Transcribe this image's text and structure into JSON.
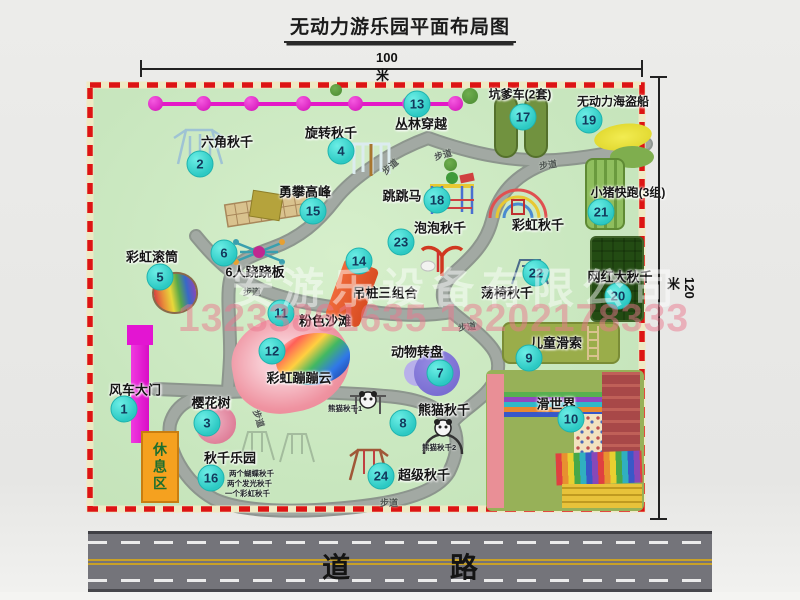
{
  "title": "无动力游乐园平面布局图",
  "dimensions": {
    "width_label": "100米",
    "height_label": "120米"
  },
  "road": {
    "label": "道  路"
  },
  "watermark": {
    "company": "安游乐设备有限公司",
    "phone": "13233861635 13202178333"
  },
  "walkway_label": "步道",
  "rest_area_label": "休息区",
  "park": {
    "attractions": [
      {
        "num": 1,
        "label": "风车大门",
        "bx": 124,
        "by": 409,
        "lx": 135,
        "ly": 389
      },
      {
        "num": 2,
        "label": "六角秋千",
        "bx": 200,
        "by": 164,
        "lx": 227,
        "ly": 141
      },
      {
        "num": 3,
        "label": "樱花树",
        "bx": 207,
        "by": 423,
        "lx": 211,
        "ly": 402
      },
      {
        "num": 4,
        "label": "旋转秋千",
        "bx": 341,
        "by": 151,
        "lx": 331,
        "ly": 132
      },
      {
        "num": 5,
        "label": "彩虹滚筒",
        "bx": 160,
        "by": 277,
        "lx": 152,
        "ly": 256
      },
      {
        "num": 6,
        "label": "6人跷跷板",
        "bx": 224,
        "by": 253,
        "lx": 255,
        "ly": 271
      },
      {
        "num": 7,
        "label": "动物转盘",
        "bx": 440,
        "by": 373,
        "lx": 417,
        "ly": 351
      },
      {
        "num": 8,
        "label": "熊猫秋千",
        "bx": 403,
        "by": 423,
        "lx": 444,
        "ly": 409
      },
      {
        "num": 9,
        "label": "儿童滑索",
        "bx": 529,
        "by": 358,
        "lx": 556,
        "ly": 342
      },
      {
        "num": 10,
        "label": "滑世界",
        "bx": 571,
        "by": 419,
        "lx": 556,
        "ly": 403
      },
      {
        "num": 11,
        "label": "粉色沙滩",
        "bx": 281,
        "by": 313,
        "lx": 325,
        "ly": 320
      },
      {
        "num": 12,
        "label": "彩虹蹦蹦云",
        "bx": 272,
        "by": 351,
        "lx": 299,
        "ly": 377
      },
      {
        "num": 13,
        "label": "丛林穿越",
        "bx": 417,
        "by": 104,
        "lx": 421,
        "ly": 123
      },
      {
        "num": 14,
        "label": "吊桩三组合",
        "bx": 359,
        "by": 261,
        "lx": 385,
        "ly": 292
      },
      {
        "num": 15,
        "label": "勇攀高峰",
        "bx": 313,
        "by": 211,
        "lx": 305,
        "ly": 191
      },
      {
        "num": 16,
        "label": "秋千乐园",
        "bx": 211,
        "by": 478,
        "lx": 230,
        "ly": 457
      },
      {
        "num": 17,
        "label": "坑爹车(2套)",
        "bx": 523,
        "by": 117,
        "lx": 520,
        "ly": 94,
        "fs": 12
      },
      {
        "num": 18,
        "label": "跳跳马",
        "bx": 437,
        "by": 200,
        "lx": 402,
        "ly": 195
      },
      {
        "num": 19,
        "label": "无动力海盗船",
        "bx": 589,
        "by": 120,
        "lx": 613,
        "ly": 101,
        "fs": 12
      },
      {
        "num": 20,
        "label": "网红大秋千",
        "bx": 618,
        "by": 296,
        "lx": 620,
        "ly": 276
      },
      {
        "num": 21,
        "label": "小猪快跑(3组)",
        "bx": 601,
        "by": 212,
        "lx": 628,
        "ly": 192,
        "fs": 12
      },
      {
        "num": 22,
        "label": "荡椅秋千",
        "bx": 536,
        "by": 273,
        "lx": 507,
        "ly": 292
      },
      {
        "num": 23,
        "label": "泡泡秋千",
        "bx": 401,
        "by": 242,
        "lx": 440,
        "ly": 227
      },
      {
        "num": 24,
        "label": "超级秋千",
        "bx": 381,
        "by": 476,
        "lx": 424,
        "ly": 474
      },
      {
        "num": null,
        "label": "彩虹秋千",
        "lx": 538,
        "ly": 224
      }
    ],
    "swing_park_notes": [
      "两个蝴蝶秋千",
      "两个发光秋千",
      "一个彩虹秋千"
    ],
    "panda_labels": {
      "p1": "熊猫秋千1",
      "p2": "熊猫秋千2"
    }
  },
  "colors": {
    "badge": "#2cc9c3",
    "park_green": "#c9e7bf",
    "boundary_red": "#dd1414",
    "gate_magenta": "#e315d2",
    "rest_area_orange": "#f5a11f",
    "zipline_magenta": "#e418c8",
    "road_gray": "#74747a"
  }
}
